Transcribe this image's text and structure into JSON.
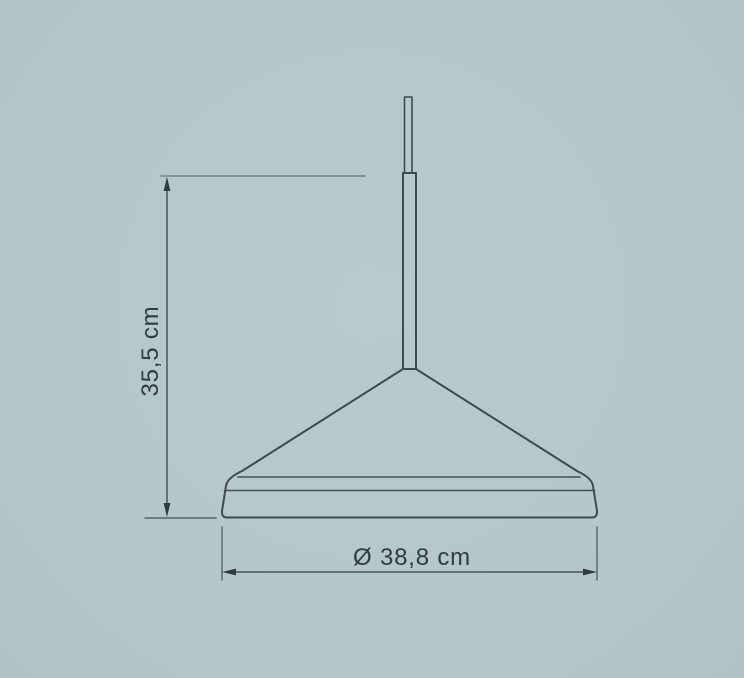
{
  "title": "Pendant lamp technical dimension drawing",
  "colors": {
    "background": "#b4c7c9",
    "outline": "#3e4b4e",
    "dimension_line": "#46545a",
    "label_text": "#303c40"
  },
  "drawing": {
    "object": "cone-pendant-lamp"
  },
  "dimensions": {
    "height": {
      "label": "35,5 cm",
      "orientation": "vertical"
    },
    "diameter": {
      "label": "Ø 38,8 cm",
      "orientation": "horizontal"
    }
  }
}
